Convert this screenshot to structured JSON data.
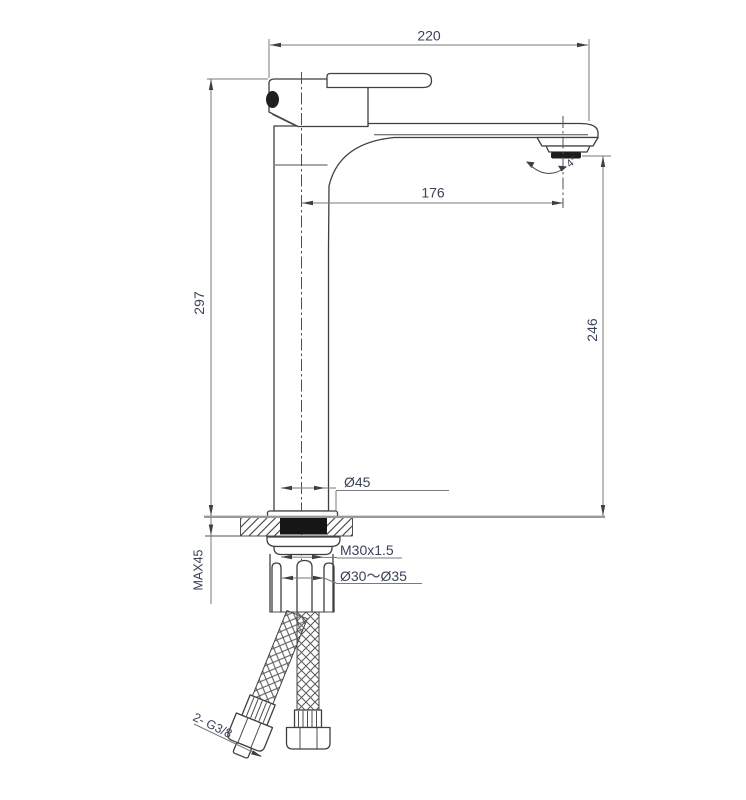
{
  "drawing": {
    "type": "faucet-installation-dimension-drawing",
    "labels": {
      "total_length": "220",
      "spout_reach": "176",
      "height_overall": "297",
      "spout_height": "246",
      "base_diameter": "Ø45",
      "mount_thread": "M30x1.5",
      "mount_hole": "Ø30～Ø35",
      "max_counter_thickness": "MAX45",
      "supply_hoses": "2- G3/8",
      "aerator_angle": "4°"
    },
    "colors": {
      "object_line": "#3f3f3f",
      "dimension_line": "#7a7a7a",
      "text": "#3a4257",
      "counter_surface": "#9a9a9a",
      "gasket": "#161616",
      "background": "#ffffff"
    }
  }
}
